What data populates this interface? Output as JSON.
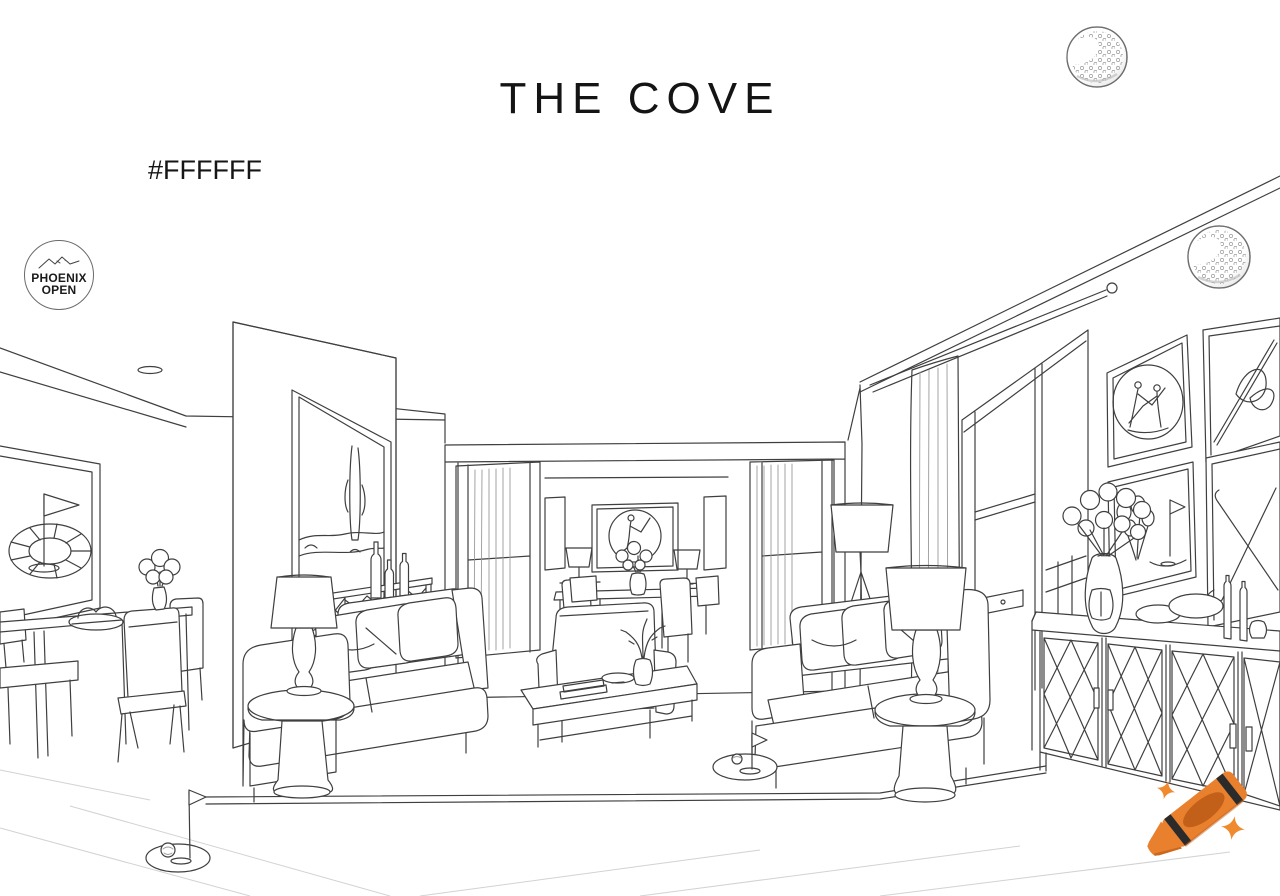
{
  "header": {
    "title": "THE COVE",
    "hex_code": "#FFFFFF"
  },
  "badge": {
    "line1": "PHOENIX",
    "line2": "OPEN"
  },
  "illustration": {
    "subject": "black-and-white line-art coloring page of a living room interior with golf decor",
    "elements": [
      "dining table",
      "sofas",
      "coffee table",
      "armchair",
      "table lamps",
      "tripod floor lamp",
      "console with lattice doors",
      "sideboard",
      "golf wall art",
      "indoor putting greens with flags",
      "vases with flowers"
    ]
  },
  "icons": {
    "golf_ball": "golf-ball-icon",
    "crayon": "crayon-icon",
    "sparkle": "sparkle-icon",
    "mountain": "mountain-icon"
  },
  "colors": {
    "background": "#FFFFFF",
    "line": "#3F3F3F",
    "crayon_body": "#E8802E",
    "crayon_shadow": "#C2601A",
    "crayon_stripe": "#2B2B2B",
    "sparkle": "#F08A2E",
    "text": "#161616"
  }
}
